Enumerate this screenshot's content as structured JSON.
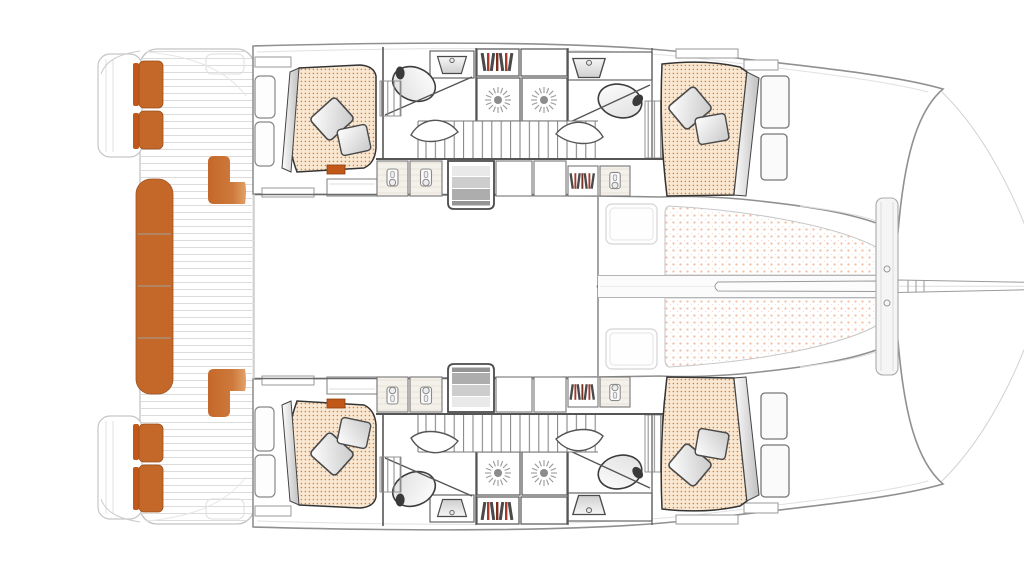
{
  "meta": {
    "title": "Catamaran accommodation and deck floor plan",
    "view": "top-down",
    "visible_text": "none"
  },
  "colors": {
    "upholstery_orange": "#C4682A",
    "upholstery_dark_orange": "#C25818",
    "mattress_bg": "#F8E8D3",
    "mattress_dot": "#D9803C",
    "trampoline_dot": "#F2BFA8",
    "book_dark": "#4A4A4A",
    "book_red": "#A33A2A",
    "hull_outline": "#909090",
    "wall_line": "#555555",
    "deck_plank_line": "#DCDCDC",
    "shower_center": "#8C8C8C"
  },
  "icons": [
    "toilet-icon",
    "sink-icon",
    "shower-head-icon",
    "bookshelf-icon",
    "wardrobe-hanger-icon",
    "companionway-stairs-icon",
    "hull-stairs-icon",
    "door-swing-icon",
    "pillow-icon",
    "deck-hatch-icon",
    "bed-mattress-icon",
    "bench-cushion-icon",
    "trampoline-icon",
    "bowsprit-icon",
    "boom-icon",
    "crossbeam-icon"
  ]
}
